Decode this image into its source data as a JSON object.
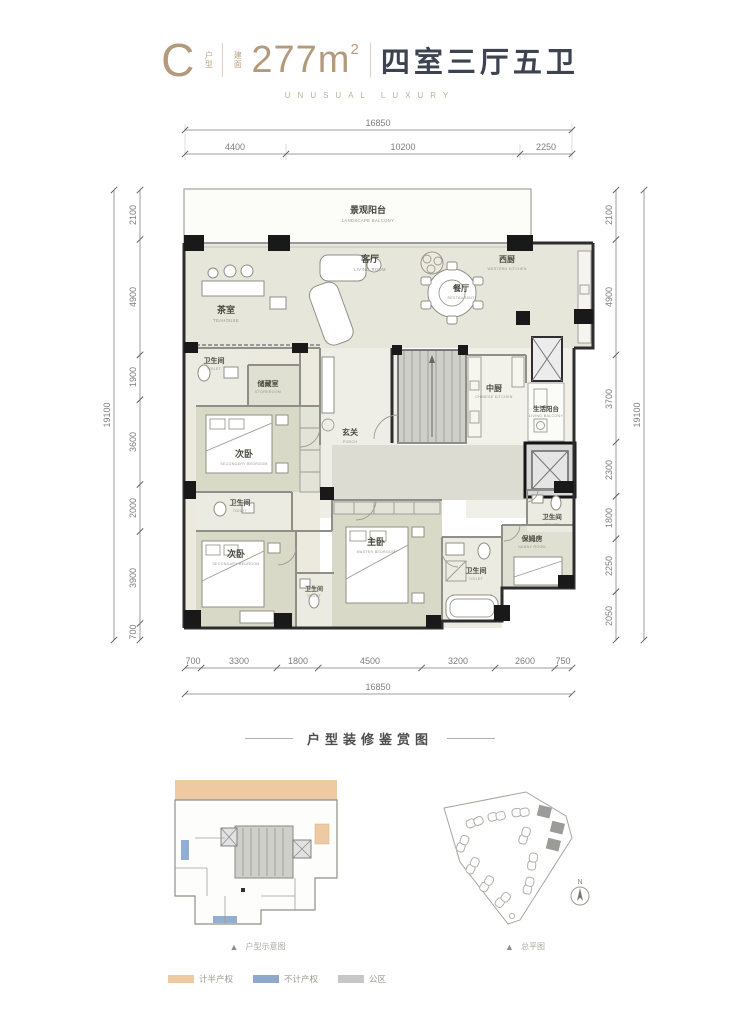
{
  "header": {
    "unit_letter": "C",
    "unit_suffix": "户型",
    "area_prefix": "建面",
    "area_value": "277m",
    "area_exp": "2",
    "layout_text": "四室三厅五卫",
    "tagline": "UNUSUAL LUXURY"
  },
  "dims": {
    "top_total": "16850",
    "top": [
      "4400",
      "10200",
      "2250"
    ],
    "left_total": "19100",
    "left": [
      "2100",
      "4900",
      "1900",
      "3600",
      "2000",
      "3900",
      "700"
    ],
    "right_total": "19100",
    "right": [
      "2100",
      "4900",
      "3700",
      "2300",
      "1800",
      "2250",
      "2050"
    ],
    "bottom": [
      "700",
      "3300",
      "1800",
      "4500",
      "3200",
      "2600",
      "750"
    ],
    "bottom_total": "16850"
  },
  "rooms": {
    "balcony": {
      "cn": "景观阳台",
      "en": "LANDSCAPE BALCONY"
    },
    "tea": {
      "cn": "茶室",
      "en": "TEAHOUSE"
    },
    "living": {
      "cn": "客厅",
      "en": "LIVING ROOM"
    },
    "dining": {
      "cn": "餐厅",
      "en": "RESTAURANT"
    },
    "west_kitchen": {
      "cn": "西厨",
      "en": "WESTERN KITCHEN"
    },
    "toilet1": {
      "cn": "卫生间",
      "en": "TOILET"
    },
    "storage": {
      "cn": "储藏室",
      "en": "STOREROOM"
    },
    "bedroom_a": {
      "cn": "次卧",
      "en": "SECONDARY BEDROOM"
    },
    "porch": {
      "cn": "玄关",
      "en": "PORCH"
    },
    "cn_kitchen": {
      "cn": "中厨",
      "en": "CHINESE KITCHEN"
    },
    "life_balcony": {
      "cn": "生活阳台",
      "en": "LIVING BALCONY"
    },
    "toilet2": {
      "cn": "卫生间",
      "en": "TOILET"
    },
    "bedroom_b": {
      "cn": "次卧",
      "en": "SECONDARY BEDROOM"
    },
    "toilet3": {
      "cn": "卫生间",
      "en": "TOILET"
    },
    "master": {
      "cn": "主卧",
      "en": "MASTER BEDROOM"
    },
    "toilet4": {
      "cn": "卫生间",
      "en": "TOILET"
    },
    "nanny": {
      "cn": "保姆房",
      "en": "NANNY ROOM"
    },
    "toilet5": {
      "cn": "卫生间",
      "en": "TOILET"
    }
  },
  "section_divider": "户型装修鉴赏图",
  "keyplan": {
    "caption": "户型示意图"
  },
  "siteplan": {
    "caption": "总平图",
    "compass": "N"
  },
  "icons": {
    "triangle_marker": "▲"
  },
  "legend": [
    {
      "label": "计半产权",
      "color": "#edcaa4"
    },
    {
      "label": "不计产权",
      "color": "#8fa9cc"
    },
    {
      "label": "公区",
      "color": "#c7c7c7"
    }
  ],
  "colors": {
    "accent_tan": "#b49a7d",
    "dark_text": "#3d4350",
    "dimension": "#7e7e7e",
    "wall": "#2d2d2d",
    "room_beige": "#e7e6db",
    "room_green": "#d8d9c7",
    "core_gray": "#cfcfc9"
  }
}
